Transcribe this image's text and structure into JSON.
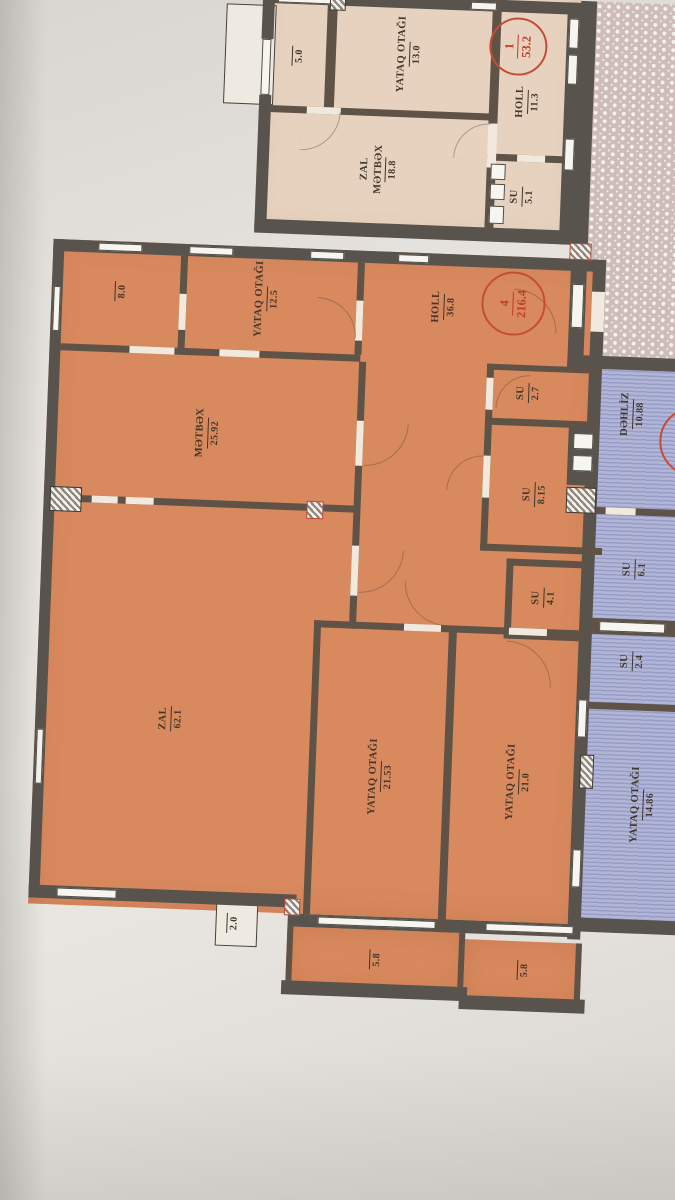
{
  "units": {
    "unit1": {
      "tag": {
        "number": "1",
        "total": "53.2"
      },
      "balcony_area": "5.0",
      "bedroom": {
        "name": "YATAQ OTAĞI",
        "area": "13.0"
      },
      "zal_metbex": {
        "line1": "ZAL",
        "line2": "MƏTBƏX",
        "area": "18.8"
      },
      "holl": {
        "name": "HOLL",
        "area": "11.3"
      },
      "su": {
        "name": "SU",
        "area": "5.1"
      }
    },
    "unit4": {
      "tag": {
        "number": "4",
        "total": "216.4"
      },
      "store_area": "8.0",
      "bedroom_top": {
        "name": "YATAQ OTAĞI",
        "area": "12.5"
      },
      "holl": {
        "name": "HOLL",
        "area": "36.8"
      },
      "metbex": {
        "name": "MƏTBƏX",
        "area": "25.92"
      },
      "su_a": {
        "name": "SU",
        "area": "2.7"
      },
      "su_b": {
        "name": "SU",
        "area": "8.15"
      },
      "su_c": {
        "name": "SU",
        "area": "4.1"
      },
      "zal": {
        "name": "ZAL",
        "area": "62.1"
      },
      "bedroom_a": {
        "name": "YATAQ OTAĞI",
        "area": "21.53"
      },
      "bedroom_b": {
        "name": "YATAQ OTAĞI",
        "area": "21.0"
      },
      "balcony_a_area": "5.8",
      "balcony_b_area": "5.8",
      "balcony_c_area": "2.0"
    },
    "neighbor": {
      "dehliz": {
        "name": "DƏHLİZ",
        "area": "10.88"
      },
      "su_a": {
        "name": "SU",
        "area": "6.1"
      },
      "su_b": {
        "name": "SU",
        "area": "2.4"
      },
      "bedroom": {
        "name": "YATAQ OTAĞI",
        "area": "14.86"
      }
    }
  },
  "colors": {
    "unit_fill": "#d8895e",
    "neighbor_top_fill": "#e7d2bf",
    "neighbor_right_fill": "#aab0d4",
    "wall": "#59534d",
    "annotation_red": "#c54c38"
  }
}
